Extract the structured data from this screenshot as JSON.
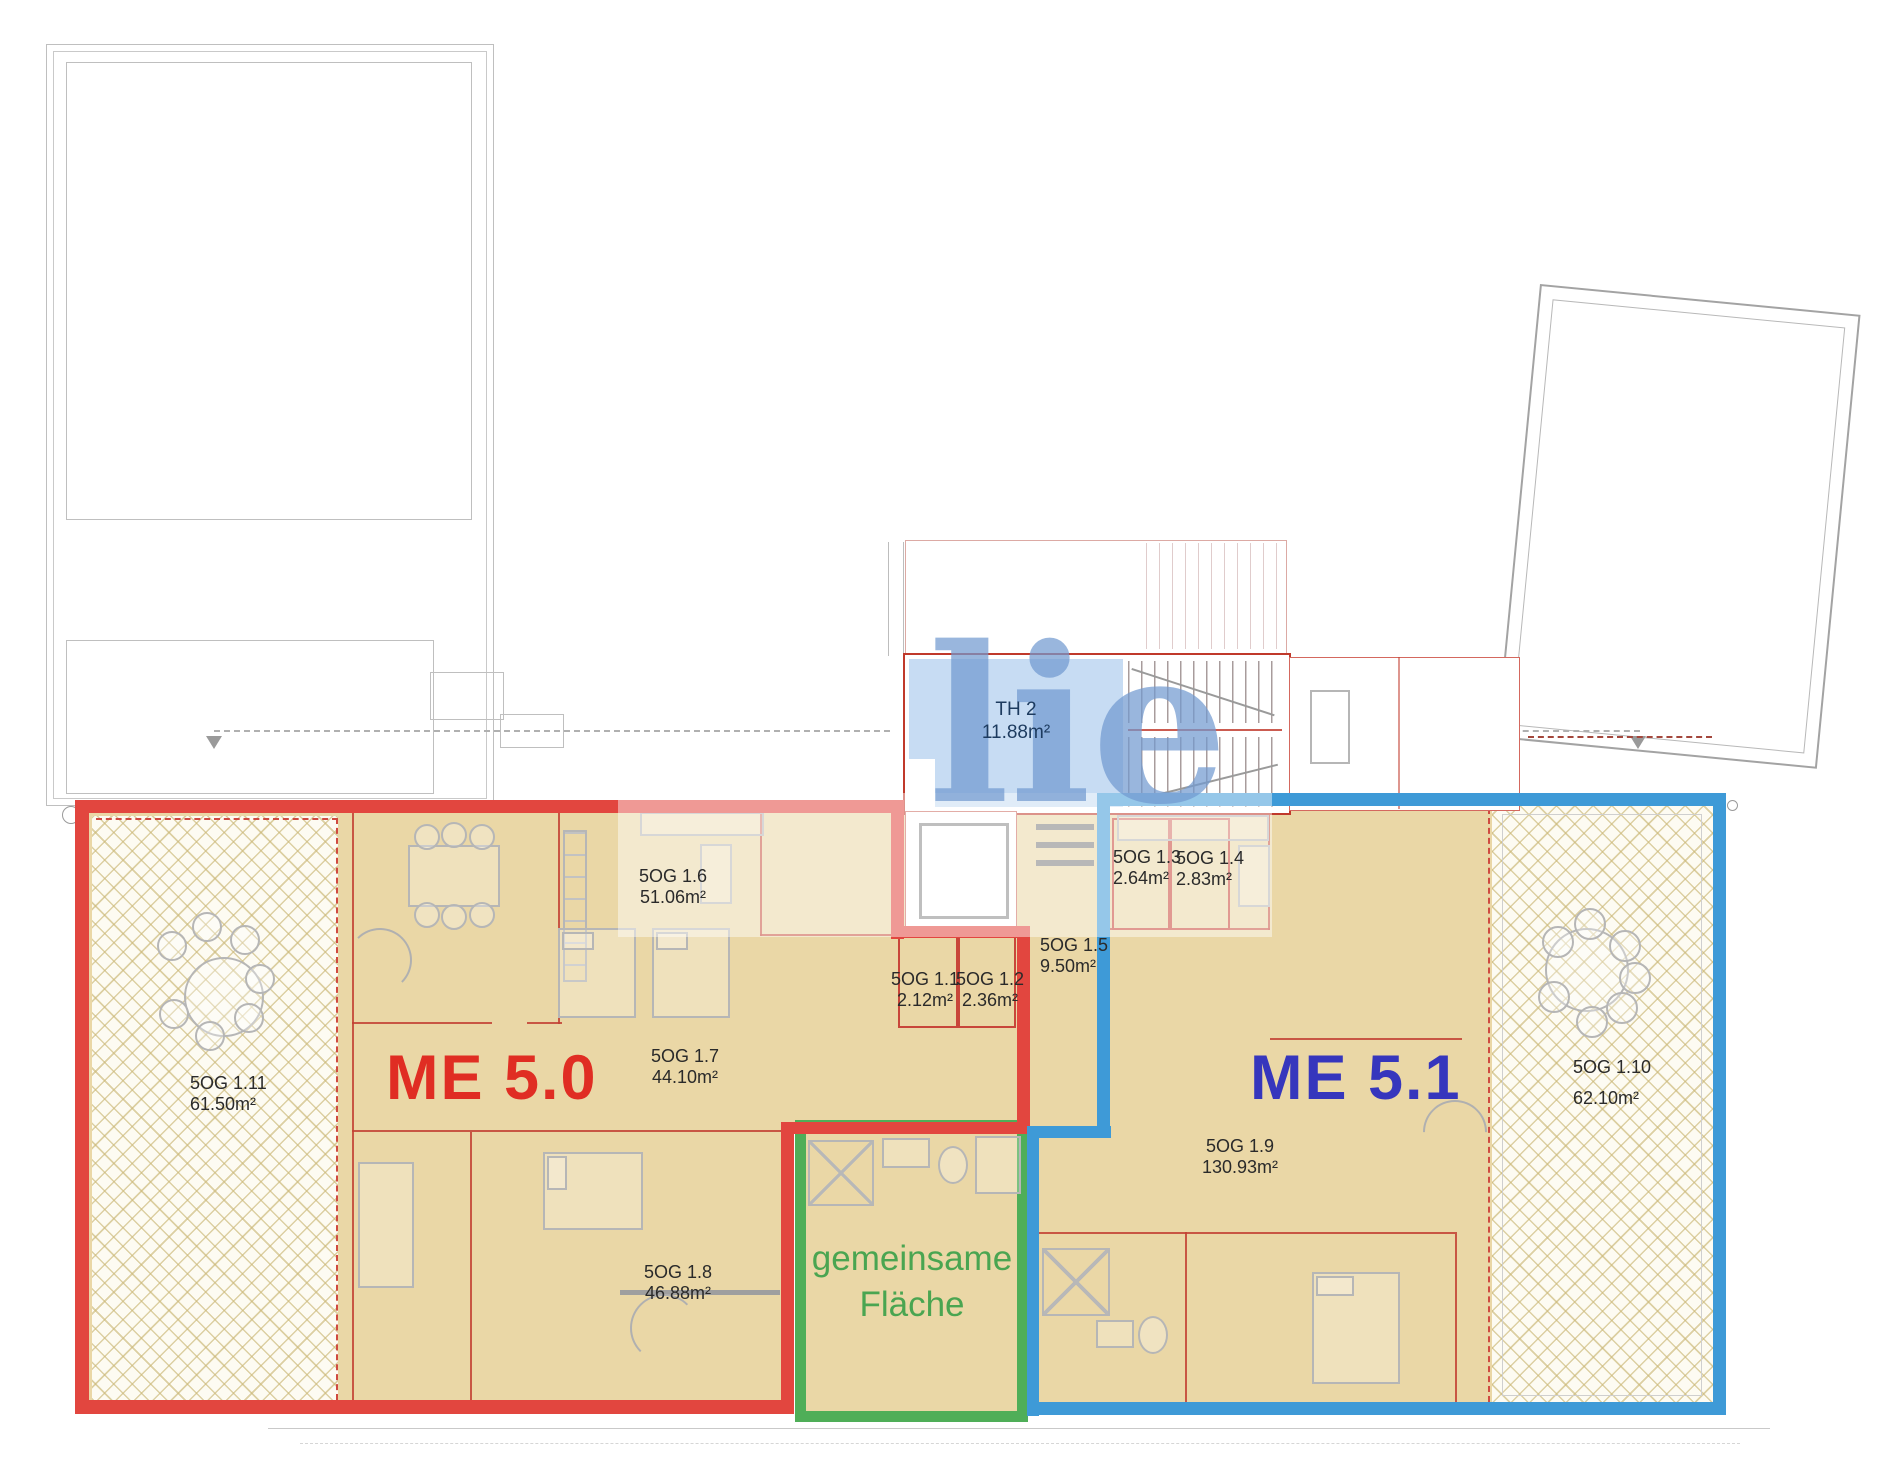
{
  "plan": {
    "units": {
      "left": {
        "label": "ME 5.0",
        "color": "#e02d23"
      },
      "right": {
        "label": "ME 5.1",
        "color": "#3636bd"
      },
      "common": {
        "label": "gemeinsame Fläche",
        "color": "#4aa551"
      }
    },
    "stairwell": {
      "code": "TH 2",
      "area": "11.88m²"
    },
    "rooms": [
      {
        "code": "5OG 1.1",
        "area": "2.12m²"
      },
      {
        "code": "5OG 1.2",
        "area": "2.36m²"
      },
      {
        "code": "5OG 1.3",
        "area": "2.64m²"
      },
      {
        "code": "5OG 1.4",
        "area": "2.83m²"
      },
      {
        "code": "5OG 1.5",
        "area": "9.50m²"
      },
      {
        "code": "5OG 1.6",
        "area": "51.06m²"
      },
      {
        "code": "5OG 1.7",
        "area": "44.10m²"
      },
      {
        "code": "5OG 1.8",
        "area": "46.88m²"
      },
      {
        "code": "5OG 1.9",
        "area": "130.93m²"
      },
      {
        "code": "5OG 1.10",
        "area": "62.10m²"
      },
      {
        "code": "5OG 1.11",
        "area": "61.50m²"
      }
    ],
    "watermark": "lie",
    "colors": {
      "unit_left_outline": "#e2463f",
      "unit_right_outline": "#3e9ad7",
      "common_outline": "#4fae58",
      "floor_fill": "#ead7a6",
      "stair_room_fill": "#c7dcf3"
    }
  }
}
